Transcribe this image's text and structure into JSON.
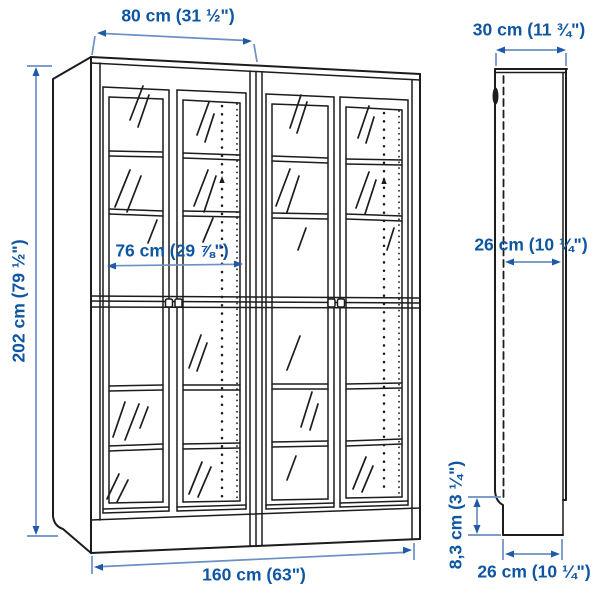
{
  "diagram": {
    "title": "bookcase-with-glass-doors-dimension-diagram",
    "views": {
      "front": "front-view-two-units-four-glass-doors",
      "side": "side-profile-view"
    },
    "labels": {
      "single_unit_width": "80 cm (31 ½\")",
      "depth": "30 cm (11 ¾\")",
      "height": "202 cm (79 ½\")",
      "inner_width": "76 cm (29 ⅞\")",
      "inner_depth": "26 cm (10 ¼\")",
      "base_height": "8,3 cm (3 ¼\")",
      "total_width": "160 cm (63\")",
      "base_depth": "26 cm (10 ¼\")"
    },
    "colors": {
      "dimension_text": "#0f56a2",
      "dimension_line": "#6b90c2",
      "dimension_arrow": "#1e5aa7",
      "artwork_line": "#1c1c1c",
      "background": "#ffffff"
    }
  }
}
